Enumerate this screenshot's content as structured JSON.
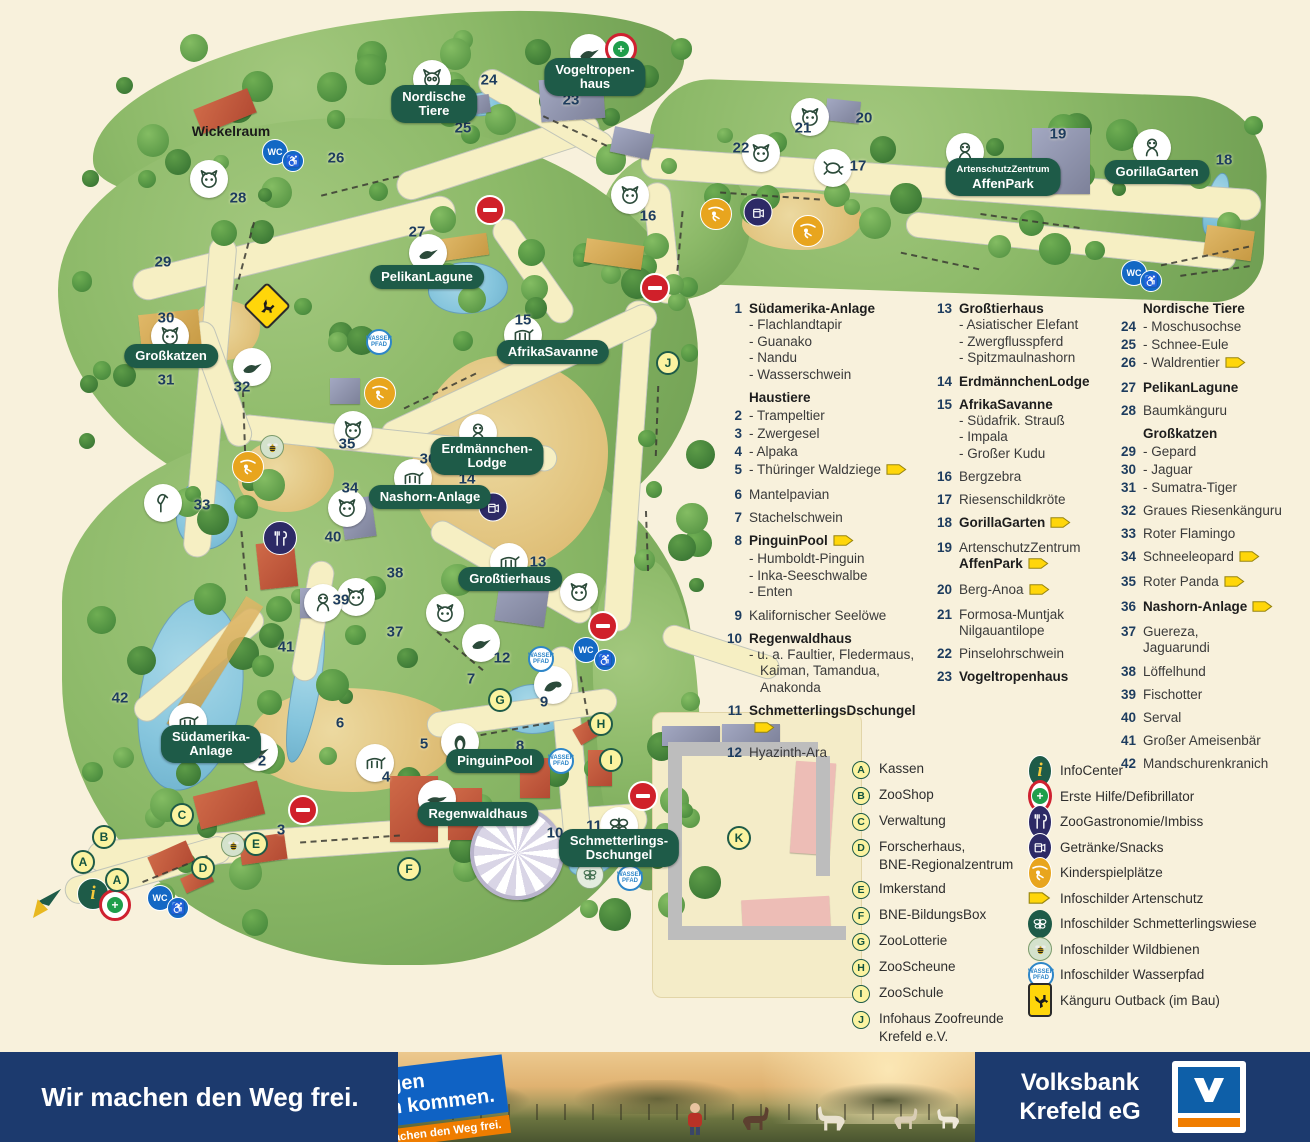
{
  "colors": {
    "pill_green": "#1e5b48",
    "number_navy": "#1d3c5e",
    "cream_bg": "#f8f1dc",
    "banner_navy": "#1c3a6e",
    "sticker_blue": "#0f62c4",
    "sticker_orange": "#ef7d00",
    "arrow_yellow": "#ffd60a",
    "logo_blue": "#0e5fa8",
    "logo_orange": "#f07d00"
  },
  "map": {
    "wickelraum": "Wickelraum",
    "area_labels": [
      {
        "id": "vogeltropenhaus",
        "lines": [
          "Vogeltropen-",
          "haus"
        ],
        "x": 595,
        "y": 77
      },
      {
        "id": "nordische-tiere",
        "lines": [
          "Nordische",
          "Tiere"
        ],
        "x": 434,
        "y": 104
      },
      {
        "id": "pelikanlagune",
        "lines": [
          "PelikanLagune"
        ],
        "x": 427,
        "y": 277
      },
      {
        "id": "afrikasavanne",
        "lines": [
          "AfrikaSavanne"
        ],
        "x": 553,
        "y": 352
      },
      {
        "id": "grosskatzen",
        "lines": [
          "Großkatzen"
        ],
        "x": 171,
        "y": 356
      },
      {
        "id": "erdmaennchen-lodge",
        "lines": [
          "Erdmännchen-",
          "Lodge"
        ],
        "x": 487,
        "y": 456
      },
      {
        "id": "nashorn-anlage",
        "lines": [
          "Nashorn-Anlage"
        ],
        "x": 430,
        "y": 497
      },
      {
        "id": "grosstierhaus",
        "lines": [
          "Großtierhaus"
        ],
        "x": 510,
        "y": 579
      },
      {
        "id": "suedamerika-anlage",
        "lines": [
          "Südamerika-",
          "Anlage"
        ],
        "x": 211,
        "y": 744
      },
      {
        "id": "pinguinpool",
        "lines": [
          "PinguinPool"
        ],
        "x": 495,
        "y": 761
      },
      {
        "id": "regenwaldhaus",
        "lines": [
          "Regenwaldhaus"
        ],
        "x": 478,
        "y": 814
      },
      {
        "id": "schmetterlings-dschungel",
        "lines": [
          "Schmetterlings-",
          "Dschungel"
        ],
        "x": 619,
        "y": 848
      },
      {
        "id": "artenschutzzentrum-affenpark",
        "lines": [
          "ArtenschutzZentrum",
          "AffenPark"
        ],
        "small_first": true,
        "x": 1003,
        "y": 177
      },
      {
        "id": "gorillagarten",
        "lines": [
          "GorillaGarten"
        ],
        "x": 1157,
        "y": 172
      }
    ],
    "numbers": [
      {
        "n": "2",
        "x": 262,
        "y": 761
      },
      {
        "n": "3",
        "x": 281,
        "y": 830
      },
      {
        "n": "4",
        "x": 386,
        "y": 777
      },
      {
        "n": "5",
        "x": 424,
        "y": 744
      },
      {
        "n": "6",
        "x": 340,
        "y": 723
      },
      {
        "n": "7",
        "x": 471,
        "y": 679
      },
      {
        "n": "8",
        "x": 520,
        "y": 746
      },
      {
        "n": "9",
        "x": 544,
        "y": 702
      },
      {
        "n": "10",
        "x": 555,
        "y": 833
      },
      {
        "n": "11",
        "x": 594,
        "y": 826
      },
      {
        "n": "12",
        "x": 502,
        "y": 658
      },
      {
        "n": "13",
        "x": 538,
        "y": 562
      },
      {
        "n": "14",
        "x": 467,
        "y": 479
      },
      {
        "n": "15",
        "x": 523,
        "y": 320
      },
      {
        "n": "16",
        "x": 648,
        "y": 216
      },
      {
        "n": "17",
        "x": 858,
        "y": 166
      },
      {
        "n": "18",
        "x": 1224,
        "y": 160
      },
      {
        "n": "19",
        "x": 1058,
        "y": 134
      },
      {
        "n": "20",
        "x": 864,
        "y": 118
      },
      {
        "n": "21",
        "x": 803,
        "y": 128
      },
      {
        "n": "22",
        "x": 741,
        "y": 148
      },
      {
        "n": "23",
        "x": 571,
        "y": 100
      },
      {
        "n": "24",
        "x": 489,
        "y": 80
      },
      {
        "n": "25",
        "x": 463,
        "y": 128
      },
      {
        "n": "26",
        "x": 336,
        "y": 158
      },
      {
        "n": "27",
        "x": 417,
        "y": 232
      },
      {
        "n": "28",
        "x": 238,
        "y": 198
      },
      {
        "n": "29",
        "x": 163,
        "y": 262
      },
      {
        "n": "30",
        "x": 166,
        "y": 318
      },
      {
        "n": "31",
        "x": 166,
        "y": 380
      },
      {
        "n": "32",
        "x": 242,
        "y": 387
      },
      {
        "n": "33",
        "x": 202,
        "y": 505
      },
      {
        "n": "34",
        "x": 350,
        "y": 488
      },
      {
        "n": "35",
        "x": 347,
        "y": 444
      },
      {
        "n": "36",
        "x": 428,
        "y": 459
      },
      {
        "n": "37",
        "x": 395,
        "y": 632
      },
      {
        "n": "38",
        "x": 395,
        "y": 573
      },
      {
        "n": "39",
        "x": 341,
        "y": 600
      },
      {
        "n": "40",
        "x": 333,
        "y": 537
      },
      {
        "n": "41",
        "x": 286,
        "y": 647
      },
      {
        "n": "42",
        "x": 120,
        "y": 698
      }
    ],
    "letters": [
      {
        "l": "A",
        "x": 83,
        "y": 862
      },
      {
        "l": "A",
        "x": 117,
        "y": 880
      },
      {
        "l": "B",
        "x": 104,
        "y": 837
      },
      {
        "l": "C",
        "x": 182,
        "y": 815
      },
      {
        "l": "D",
        "x": 203,
        "y": 868
      },
      {
        "l": "E",
        "x": 256,
        "y": 844
      },
      {
        "l": "F",
        "x": 409,
        "y": 869
      },
      {
        "l": "G",
        "x": 500,
        "y": 700
      },
      {
        "l": "H",
        "x": 601,
        "y": 724
      },
      {
        "l": "I",
        "x": 611,
        "y": 760
      },
      {
        "l": "J",
        "x": 668,
        "y": 363
      },
      {
        "l": "K",
        "x": 739,
        "y": 838
      }
    ],
    "animals": [
      {
        "name": "owl",
        "g": "owl",
        "x": 432,
        "y": 79
      },
      {
        "name": "toucan",
        "g": "bird",
        "x": 589,
        "y": 53
      },
      {
        "name": "wolf",
        "g": "face",
        "x": 209,
        "y": 179
      },
      {
        "name": "zebra",
        "g": "face",
        "x": 630,
        "y": 195
      },
      {
        "name": "pelican",
        "g": "bird",
        "x": 428,
        "y": 253
      },
      {
        "name": "tiger",
        "g": "face",
        "x": 170,
        "y": 336
      },
      {
        "name": "cockatoo",
        "g": "bird",
        "x": 252,
        "y": 367
      },
      {
        "name": "antelope",
        "g": "quad",
        "x": 523,
        "y": 335
      },
      {
        "name": "red-panda",
        "g": "face",
        "x": 353,
        "y": 430
      },
      {
        "name": "snow-leopard",
        "g": "face",
        "x": 347,
        "y": 508
      },
      {
        "name": "rhino",
        "g": "quad",
        "x": 413,
        "y": 478
      },
      {
        "name": "meerkat",
        "g": "primate",
        "x": 478,
        "y": 433
      },
      {
        "name": "flamingo",
        "g": "flamingo",
        "x": 163,
        "y": 503
      },
      {
        "name": "elephant",
        "g": "quad",
        "x": 509,
        "y": 562
      },
      {
        "name": "hippo",
        "g": "face",
        "x": 579,
        "y": 592
      },
      {
        "name": "goat",
        "g": "face",
        "x": 445,
        "y": 613
      },
      {
        "name": "macaw",
        "g": "bird",
        "x": 481,
        "y": 643
      },
      {
        "name": "otter",
        "g": "face",
        "x": 356,
        "y": 597
      },
      {
        "name": "colobus",
        "g": "primate",
        "x": 323,
        "y": 603
      },
      {
        "name": "sea-lion",
        "g": "seal",
        "x": 553,
        "y": 685
      },
      {
        "name": "waldziege",
        "g": "quad",
        "x": 188,
        "y": 722
      },
      {
        "name": "rhea",
        "g": "bird",
        "x": 259,
        "y": 752
      },
      {
        "name": "camel",
        "g": "quad",
        "x": 375,
        "y": 763
      },
      {
        "name": "penguin",
        "g": "penguin",
        "x": 460,
        "y": 742
      },
      {
        "name": "crocodile",
        "g": "croc",
        "x": 437,
        "y": 799
      },
      {
        "name": "butterfly",
        "g": "butterfly",
        "x": 619,
        "y": 826
      },
      {
        "name": "anoa",
        "g": "face",
        "x": 810,
        "y": 117
      },
      {
        "name": "boar",
        "g": "face",
        "x": 761,
        "y": 153
      },
      {
        "name": "tortoise",
        "g": "turtle",
        "x": 833,
        "y": 168
      },
      {
        "name": "monkey",
        "g": "primate",
        "x": 965,
        "y": 152
      },
      {
        "name": "gorilla",
        "g": "primate",
        "x": 1152,
        "y": 148
      }
    ],
    "amenities": [
      {
        "t": "wc",
        "x": 275,
        "y": 152
      },
      {
        "t": "wheel",
        "x": 293,
        "y": 161
      },
      {
        "t": "wc",
        "x": 586,
        "y": 650
      },
      {
        "t": "wheel",
        "x": 605,
        "y": 660
      },
      {
        "t": "wc",
        "x": 1134,
        "y": 273
      },
      {
        "t": "wheel",
        "x": 1151,
        "y": 281
      },
      {
        "t": "wc",
        "x": 160,
        "y": 898
      },
      {
        "t": "wheel",
        "x": 178,
        "y": 908
      },
      {
        "t": "noentry",
        "x": 490,
        "y": 210
      },
      {
        "t": "noentry",
        "x": 655,
        "y": 288
      },
      {
        "t": "noentry",
        "x": 603,
        "y": 626
      },
      {
        "t": "noentry",
        "x": 303,
        "y": 810
      },
      {
        "t": "noentry",
        "x": 643,
        "y": 796
      },
      {
        "t": "play",
        "x": 380,
        "y": 393
      },
      {
        "t": "play",
        "x": 248,
        "y": 467
      },
      {
        "t": "play",
        "x": 716,
        "y": 214
      },
      {
        "t": "play",
        "x": 808,
        "y": 231
      },
      {
        "t": "rest",
        "x": 280,
        "y": 538
      },
      {
        "t": "drink",
        "x": 493,
        "y": 507
      },
      {
        "t": "drink",
        "x": 758,
        "y": 212
      },
      {
        "t": "info",
        "x": 93,
        "y": 894
      },
      {
        "t": "aid",
        "x": 115,
        "y": 905
      },
      {
        "t": "aid",
        "x": 621,
        "y": 49
      },
      {
        "t": "wasser",
        "x": 379,
        "y": 342
      },
      {
        "t": "wasser",
        "x": 541,
        "y": 659
      },
      {
        "t": "wasser",
        "x": 561,
        "y": 761
      },
      {
        "t": "wasser",
        "x": 630,
        "y": 878
      },
      {
        "t": "bee",
        "x": 272,
        "y": 447
      },
      {
        "t": "bee",
        "x": 233,
        "y": 845
      },
      {
        "t": "bfly",
        "x": 590,
        "y": 875
      },
      {
        "t": "kang",
        "x": 267,
        "y": 306
      },
      {
        "t": "flag",
        "x": 48,
        "y": 903
      }
    ]
  },
  "legend": {
    "columns": [
      {
        "x": 718,
        "y": 300,
        "entries": [
          {
            "num": "1",
            "label": "Südamerika-Anlage",
            "bold": true,
            "subs": [
              "- Flachlandtapir",
              "- Guanako",
              "- Nandu",
              "- Wasserschwein"
            ]
          },
          {
            "num": "",
            "label": "Haustiere",
            "bold": true,
            "tight": true
          },
          {
            "num": "2",
            "label": "- Trampeltier",
            "tight": true
          },
          {
            "num": "3",
            "label": "- Zwergesel",
            "tight": true
          },
          {
            "num": "4",
            "label": "- Alpaka",
            "tight": true
          },
          {
            "num": "5",
            "label": "- Thüringer Waldziege",
            "arrow": true
          },
          {
            "num": "6",
            "label": "Mantelpavian"
          },
          {
            "num": "7",
            "label": "Stachelschwein"
          },
          {
            "num": "8",
            "label": "PinguinPool",
            "bold": true,
            "arrow": true,
            "subs": [
              "- Humboldt-Pinguin",
              "- Inka-Seeschwalbe",
              "- Enten"
            ]
          },
          {
            "num": "9",
            "label": "Kalifornischer Seelöwe"
          },
          {
            "num": "10",
            "label": "Regenwaldhaus",
            "bold": true,
            "subs": [
              "- u. a. Faultier, Fledermaus,",
              "Kaiman, Tamandua,",
              "Anakonda"
            ]
          },
          {
            "num": "11",
            "label": "SchmetterlingsDschungel",
            "bold": true,
            "arrow": true
          },
          {
            "num": "12",
            "label": "Hyazinth-Ara"
          }
        ]
      },
      {
        "x": 928,
        "y": 300,
        "entries": [
          {
            "num": "13",
            "label": "Großtierhaus",
            "bold": true,
            "subs": [
              "- Asiatischer Elefant",
              "- Zwergflusspferd",
              "- Spitzmaulnashorn"
            ]
          },
          {
            "num": "14",
            "label": "ErdmännchenLodge",
            "bold": true
          },
          {
            "num": "15",
            "label": "AfrikaSavanne",
            "bold": true,
            "subs": [
              "- Südafrik. Strauß",
              "- Impala",
              "- Großer Kudu"
            ]
          },
          {
            "num": "16",
            "label": "Bergzebra"
          },
          {
            "num": "17",
            "label": "Riesenschildkröte"
          },
          {
            "num": "18",
            "label": "GorillaGarten",
            "bold": true,
            "arrow": true
          },
          {
            "num": "19",
            "label": "ArtenschutzZentrum",
            "label2": "AffenPark",
            "label2_bold": true,
            "label2_arrow": true
          },
          {
            "num": "20",
            "label": "Berg-Anoa",
            "arrow": true
          },
          {
            "num": "21",
            "label": "Formosa-Muntjak",
            "label2": "Nilgauantilope"
          },
          {
            "num": "22",
            "label": "Pinselohrschwein"
          },
          {
            "num": "23",
            "label": "Vogeltropenhaus",
            "bold": true
          }
        ]
      },
      {
        "x": 1112,
        "y": 300,
        "entries": [
          {
            "num": "",
            "label": "Nordische Tiere",
            "bold": true,
            "tight": true
          },
          {
            "num": "24",
            "label": "- Moschusochse",
            "tight": true
          },
          {
            "num": "25",
            "label": "- Schnee-Eule",
            "tight": true
          },
          {
            "num": "26",
            "label": "- Waldrentier",
            "arrow": true
          },
          {
            "num": "27",
            "label": "PelikanLagune",
            "bold": true
          },
          {
            "num": "28",
            "label": "Baumkänguru"
          },
          {
            "num": "",
            "label": "Großkatzen",
            "bold": true,
            "tight": true
          },
          {
            "num": "29",
            "label": "- Gepard",
            "tight": true
          },
          {
            "num": "30",
            "label": "- Jaguar",
            "tight": true
          },
          {
            "num": "31",
            "label": "- Sumatra-Tiger"
          },
          {
            "num": "32",
            "label": "Graues Riesenkänguru"
          },
          {
            "num": "33",
            "label": "Roter Flamingo"
          },
          {
            "num": "34",
            "label": "Schneeleopard",
            "arrow": true
          },
          {
            "num": "35",
            "label": "Roter Panda",
            "arrow": true
          },
          {
            "num": "36",
            "label": "Nashorn-Anlage",
            "bold": true,
            "arrow": true
          },
          {
            "num": "37",
            "label": "Guereza,",
            "label2": "Jaguarundi"
          },
          {
            "num": "38",
            "label": "Löffelhund"
          },
          {
            "num": "39",
            "label": "Fischotter"
          },
          {
            "num": "40",
            "label": "Serval"
          },
          {
            "num": "41",
            "label": "Großer Ameisenbär"
          },
          {
            "num": "42",
            "label": "Mandschurenkranich"
          }
        ]
      }
    ]
  },
  "letter_legend": [
    {
      "letter": "A",
      "label": "Kassen"
    },
    {
      "letter": "B",
      "label": "ZooShop"
    },
    {
      "letter": "C",
      "label": "Verwaltung"
    },
    {
      "letter": "D",
      "label": "Forscherhaus,",
      "label2": "BNE-Regionalzentrum"
    },
    {
      "letter": "E",
      "label": "Imkerstand"
    },
    {
      "letter": "F",
      "label": "BNE-BildungsBox"
    },
    {
      "letter": "G",
      "label": "ZooLotterie"
    },
    {
      "letter": "H",
      "label": "ZooScheune"
    },
    {
      "letter": "I",
      "label": "ZooSchule"
    },
    {
      "letter": "J",
      "label": "Infohaus Zoofreunde",
      "label2": "Krefeld e.V."
    },
    {
      "letter": "K",
      "label": "Wirtschaftshof",
      "note": "(kein Zugang)"
    }
  ],
  "icon_legend": [
    {
      "type": "info",
      "label": "InfoCenter"
    },
    {
      "type": "aid",
      "label": "Erste Hilfe/Defibrillator"
    },
    {
      "type": "rest",
      "label": "ZooGastronomie/Imbiss"
    },
    {
      "type": "drink",
      "label": "Getränke/Snacks"
    },
    {
      "type": "play",
      "label": "Kinderspielplätze"
    },
    {
      "type": "arrow",
      "label": "Infoschilder Artenschutz"
    },
    {
      "type": "bflygreen",
      "label": "Infoschilder Schmetterlingswiese"
    },
    {
      "type": "bee",
      "label": "Infoschilder Wildbienen"
    },
    {
      "type": "wasser",
      "label": "Infoschilder Wasserpfad"
    },
    {
      "type": "kang",
      "label": "Känguru Outback (im Bau)"
    }
  ],
  "banner": {
    "slogan": "Wir machen den Weg frei.",
    "sticker_line1": "Morgen",
    "sticker_line2": "kann kommen.",
    "sticker_sub": "Wir machen den Weg frei.",
    "bank_line1": "Volksbank",
    "bank_line2": "Krefeld eG"
  }
}
